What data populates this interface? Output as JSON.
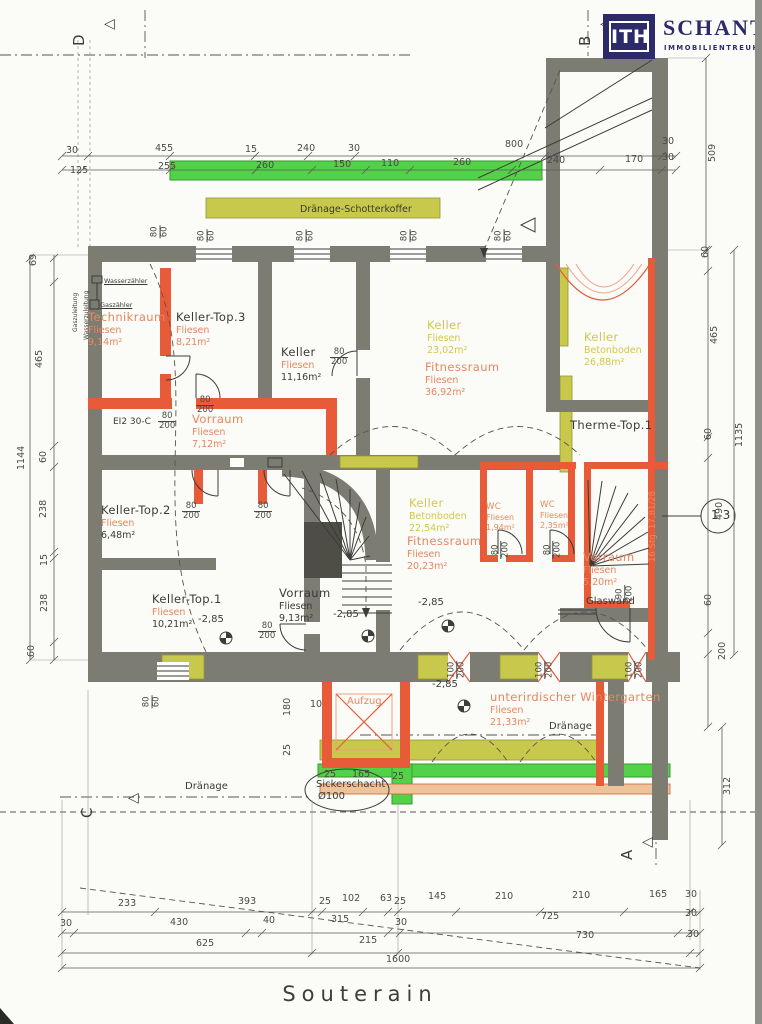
{
  "page": {
    "title": "Souterain"
  },
  "logo": {
    "abbr": "ITH",
    "name": "SCHANTL",
    "subtitle": "IMMOBILIENTREUHAND"
  },
  "colors": {
    "navy": "#2c2a6b",
    "wall": "#7c7c73",
    "orange": "#e75b38",
    "orange_light": "#f0a184",
    "text_orange": "#e8875e",
    "text_yellow": "#d5c749",
    "text_black": "#3a3a36",
    "dim_text": "#4a4a45",
    "green": "#53d148",
    "green_dark": "#2e9e2f",
    "olive": "#c8c84d",
    "olive_dark": "#97972f",
    "tan": "#eec39a"
  },
  "plan": {
    "rooms": [
      {
        "n": "room-technikraum",
        "name": "Technikraum",
        "floor": "Fliesen",
        "area": "9,14m²",
        "x": 88,
        "y": 310,
        "nc": "org",
        "fc": "org",
        "ac": "org"
      },
      {
        "n": "room-keller-top3",
        "name": "Keller-Top.3",
        "floor": "Fliesen",
        "area": "8,21m²",
        "x": 176,
        "y": 310,
        "nc": "blk",
        "fc": "org",
        "ac": "org"
      },
      {
        "n": "room-keller-11",
        "name": "Keller",
        "floor": "Fliesen",
        "area": "11,16m²",
        "x": 281,
        "y": 345,
        "nc": "blk",
        "fc": "org",
        "ac": "blk"
      },
      {
        "n": "room-keller-23",
        "name": "Keller",
        "floor": "Fliesen",
        "area": "23,02m²",
        "x": 427,
        "y": 318,
        "nc": "yel",
        "fc": "yel",
        "ac": "yel"
      },
      {
        "n": "room-fitnessraum-36",
        "name": "Fitnessraum",
        "floor": "Fliesen",
        "area": "36,92m²",
        "x": 425,
        "y": 360,
        "nc": "org",
        "fc": "org",
        "ac": "org"
      },
      {
        "n": "room-keller-26",
        "name": "Keller",
        "floor": "Betonboden",
        "area": "26,88m²",
        "x": 584,
        "y": 330,
        "nc": "yel",
        "fc": "yel",
        "ac": "yel"
      },
      {
        "n": "room-therme-top1",
        "name": "Therme-Top.1",
        "floor": "",
        "area": "",
        "x": 570,
        "y": 418,
        "nc": "blk",
        "fc": "blk",
        "ac": "blk"
      },
      {
        "n": "room-vorraum-7",
        "name": "Vorraum",
        "floor": "Fliesen",
        "area": "7,12m²",
        "x": 192,
        "y": 412,
        "nc": "org",
        "fc": "org",
        "ac": "org"
      },
      {
        "n": "room-keller-top2",
        "name": "Keller-Top.2",
        "floor": "Fliesen",
        "area": "6,48m²",
        "x": 101,
        "y": 503,
        "nc": "blk",
        "fc": "org",
        "ac": "blk"
      },
      {
        "n": "room-vorraum-9",
        "name": "Vorraum",
        "floor": "Fliesen",
        "area": "9,13m²",
        "x": 279,
        "y": 586,
        "nc": "blk",
        "fc": "blk",
        "ac": "blk"
      },
      {
        "n": "room-keller-22",
        "name": "Keller",
        "floor": "Betonboden",
        "area": "22,54m²",
        "x": 409,
        "y": 496,
        "nc": "yel",
        "fc": "yel",
        "ac": "yel"
      },
      {
        "n": "room-fitnessraum-20",
        "name": "Fitnessraum",
        "floor": "Fliesen",
        "area": "20,23m²",
        "x": 407,
        "y": 534,
        "nc": "org",
        "fc": "org",
        "ac": "org"
      },
      {
        "n": "room-wc-1",
        "name": "WC",
        "floor": "Fliesen",
        "area": "1,94m²",
        "x": 486,
        "y": 502,
        "nc": "org",
        "fc": "org",
        "ac": "org",
        "sm": 1
      },
      {
        "n": "room-wc-2",
        "name": "WC",
        "floor": "Fliesen",
        "area": "2,35m²",
        "x": 540,
        "y": 500,
        "nc": "org",
        "fc": "org",
        "ac": "org",
        "sm": 1
      },
      {
        "n": "room-vorraum-5",
        "name": "Vorraum",
        "floor": "Fliesen",
        "area": "5,20m²",
        "x": 583,
        "y": 550,
        "nc": "org",
        "fc": "org",
        "ac": "org"
      },
      {
        "n": "room-keller-top1",
        "name": "Keller-Top.1",
        "floor": "Fliesen",
        "area": "10,21m²",
        "x": 152,
        "y": 592,
        "nc": "blk",
        "fc": "org",
        "ac": "blk"
      },
      {
        "n": "room-wintergarten",
        "name": "unterirdischer Wintergarten",
        "floor": "Fliesen",
        "area": "21,33m²",
        "x": 490,
        "y": 690,
        "nc": "org",
        "fc": "org",
        "ac": "org"
      }
    ],
    "texts": [
      {
        "n": "draenage-schotterkoffer-label",
        "t": "Dränage-Schotterkoffer",
        "x": 300,
        "y": 205,
        "s": 9.5
      },
      {
        "n": "draenage-label-mid",
        "t": "Dränage",
        "x": 549,
        "y": 722,
        "s": 10
      },
      {
        "n": "draenage-label-left",
        "t": "Dränage",
        "x": 185,
        "y": 782,
        "s": 10
      },
      {
        "n": "sickerschacht-label",
        "t": "Sickerschacht",
        "x": 316,
        "y": 780,
        "s": 10
      },
      {
        "n": "sickerschacht-diameter",
        "t": "Ø100",
        "x": 318,
        "y": 792,
        "s": 10
      },
      {
        "n": "glaswand-label",
        "t": "Glaswand",
        "x": 586,
        "y": 597,
        "s": 10
      },
      {
        "n": "aufzug-label",
        "t": "Aufzug",
        "x": 347,
        "y": 697,
        "s": 10,
        "c": "org"
      },
      {
        "n": "fire-door-label",
        "t": "EI2 30-C",
        "x": 113,
        "y": 418,
        "s": 9
      },
      {
        "n": "wasserzaehler-label",
        "t": "Wasserzähler",
        "x": 104,
        "y": 278,
        "s": 6.5,
        "u": 1
      },
      {
        "n": "gaszaehler-label",
        "t": "Gaszähler",
        "x": 100,
        "y": 302,
        "s": 6.5,
        "u": 1
      },
      {
        "n": "gaszuleitung-label",
        "t": "Gaszuleitung",
        "x": 73,
        "y": 332,
        "s": 6,
        "r": -90
      },
      {
        "n": "wasserzuleitung-label",
        "t": "Wasserzuleitung",
        "x": 84,
        "y": 340,
        "s": 6,
        "r": -90
      },
      {
        "n": "stair-count-label",
        "t": "16 Stg. 17,81/28",
        "x": 649,
        "y": 562,
        "s": 8.5,
        "r": -90,
        "c": "org"
      },
      {
        "n": "detail-circle-label",
        "t": "13",
        "x": 711,
        "y": 509,
        "s": 12,
        "ls": 4
      }
    ],
    "levels": [
      {
        "n": "level-label",
        "t": "-2,85",
        "x": 333,
        "y": 610
      },
      {
        "n": "level-label",
        "t": "-2,85",
        "x": 418,
        "y": 598
      },
      {
        "n": "level-label",
        "t": "-2,85",
        "x": 198,
        "y": 615
      },
      {
        "n": "level-label",
        "t": "-2,85",
        "x": 432,
        "y": 680
      }
    ],
    "fracs": [
      {
        "t": "80/200",
        "x": 330,
        "y": 348
      },
      {
        "t": "80/200",
        "x": 196,
        "y": 396
      },
      {
        "t": "80/200",
        "x": 158,
        "y": 412
      },
      {
        "t": "80/200",
        "x": 182,
        "y": 502
      },
      {
        "t": "80/200",
        "x": 254,
        "y": 502
      },
      {
        "t": "80/200",
        "x": 258,
        "y": 622
      },
      {
        "t": "80/200",
        "x": 492,
        "y": 540,
        "r": -90
      },
      {
        "t": "80/200",
        "x": 544,
        "y": 540,
        "r": -90
      },
      {
        "t": "90/200",
        "x": 616,
        "y": 584,
        "r": -90
      },
      {
        "t": "80/60",
        "x": 154,
        "y": 222,
        "r": -90
      },
      {
        "t": "80/60",
        "x": 201,
        "y": 226,
        "r": -90
      },
      {
        "t": "80/60",
        "x": 300,
        "y": 226,
        "r": -90
      },
      {
        "t": "80/60",
        "x": 404,
        "y": 226,
        "r": -90
      },
      {
        "t": "80/60",
        "x": 498,
        "y": 226,
        "r": -90
      },
      {
        "t": "80/60",
        "x": 146,
        "y": 692,
        "r": -90
      },
      {
        "t": "100/200",
        "x": 448,
        "y": 660,
        "r": -90
      },
      {
        "t": "100/200",
        "x": 536,
        "y": 660,
        "r": -90
      },
      {
        "t": "100/200",
        "x": 626,
        "y": 660,
        "r": -90
      }
    ],
    "dims": [
      {
        "t": "30",
        "x": 66,
        "y": 146
      },
      {
        "t": "455",
        "x": 155,
        "y": 144
      },
      {
        "t": "15",
        "x": 245,
        "y": 145
      },
      {
        "t": "240",
        "x": 297,
        "y": 144
      },
      {
        "t": "30",
        "x": 348,
        "y": 144
      },
      {
        "t": "800",
        "x": 505,
        "y": 140
      },
      {
        "t": "30",
        "x": 662,
        "y": 137
      },
      {
        "t": "125",
        "x": 70,
        "y": 166
      },
      {
        "t": "255",
        "x": 158,
        "y": 162
      },
      {
        "t": "260",
        "x": 256,
        "y": 161
      },
      {
        "t": "150",
        "x": 333,
        "y": 160
      },
      {
        "t": "110",
        "x": 381,
        "y": 159
      },
      {
        "t": "260",
        "x": 453,
        "y": 158
      },
      {
        "t": "240",
        "x": 547,
        "y": 156
      },
      {
        "t": "170",
        "x": 625,
        "y": 155
      },
      {
        "t": "30",
        "x": 662,
        "y": 153
      },
      {
        "t": "509",
        "x": 708,
        "y": 162,
        "r": -90
      },
      {
        "t": "60",
        "x": 701,
        "y": 258,
        "r": -90
      },
      {
        "t": "465",
        "x": 710,
        "y": 344,
        "r": -90
      },
      {
        "t": "60",
        "x": 704,
        "y": 440,
        "r": -90
      },
      {
        "t": "1135",
        "x": 735,
        "y": 447,
        "r": -90
      },
      {
        "t": "490",
        "x": 715,
        "y": 520,
        "r": -90
      },
      {
        "t": "60",
        "x": 704,
        "y": 606,
        "r": -90
      },
      {
        "t": "200",
        "x": 718,
        "y": 660,
        "r": -90
      },
      {
        "t": "312",
        "x": 723,
        "y": 795,
        "r": -90
      },
      {
        "t": "69",
        "x": 29,
        "y": 266,
        "r": -90
      },
      {
        "t": "465",
        "x": 35,
        "y": 368,
        "r": -90
      },
      {
        "t": "60",
        "x": 39,
        "y": 463,
        "r": -90
      },
      {
        "t": "1144",
        "x": 17,
        "y": 470,
        "r": -90
      },
      {
        "t": "238",
        "x": 39,
        "y": 518,
        "r": -90
      },
      {
        "t": "15",
        "x": 40,
        "y": 566,
        "r": -90
      },
      {
        "t": "238",
        "x": 40,
        "y": 612,
        "r": -90
      },
      {
        "t": "60",
        "x": 27,
        "y": 657,
        "r": -90
      },
      {
        "t": "233",
        "x": 118,
        "y": 899
      },
      {
        "t": "393",
        "x": 238,
        "y": 897
      },
      {
        "t": "25",
        "x": 319,
        "y": 897
      },
      {
        "t": "102",
        "x": 342,
        "y": 894
      },
      {
        "t": "63",
        "x": 380,
        "y": 894
      },
      {
        "t": "25",
        "x": 394,
        "y": 897
      },
      {
        "t": "145",
        "x": 428,
        "y": 892
      },
      {
        "t": "210",
        "x": 495,
        "y": 892
      },
      {
        "t": "210",
        "x": 572,
        "y": 891
      },
      {
        "t": "165",
        "x": 649,
        "y": 890
      },
      {
        "t": "30",
        "x": 685,
        "y": 890
      },
      {
        "t": "30",
        "x": 60,
        "y": 919
      },
      {
        "t": "430",
        "x": 170,
        "y": 918
      },
      {
        "t": "40",
        "x": 263,
        "y": 916
      },
      {
        "t": "315",
        "x": 331,
        "y": 915
      },
      {
        "t": "30",
        "x": 395,
        "y": 918
      },
      {
        "t": "725",
        "x": 541,
        "y": 912
      },
      {
        "t": "30",
        "x": 685,
        "y": 909
      },
      {
        "t": "625",
        "x": 196,
        "y": 939
      },
      {
        "t": "215",
        "x": 359,
        "y": 936
      },
      {
        "t": "730",
        "x": 576,
        "y": 931
      },
      {
        "t": "30",
        "x": 687,
        "y": 930
      },
      {
        "t": "1600",
        "x": 386,
        "y": 955
      },
      {
        "t": "180",
        "x": 283,
        "y": 716,
        "r": -90
      },
      {
        "t": "25",
        "x": 283,
        "y": 756,
        "r": -90
      },
      {
        "t": "10",
        "x": 310,
        "y": 700
      },
      {
        "t": "25",
        "x": 324,
        "y": 770
      },
      {
        "t": "165",
        "x": 352,
        "y": 770
      },
      {
        "t": "25",
        "x": 392,
        "y": 772
      }
    ],
    "markers": [
      {
        "letter": "D",
        "x": 70,
        "y": 46,
        "tx": 104,
        "ty": 16
      },
      {
        "letter": "B",
        "x": 576,
        "y": 46,
        "tx": 600,
        "ty": 16
      },
      {
        "letter": "C",
        "x": 78,
        "y": 818,
        "tx": 128,
        "ty": 790
      },
      {
        "letter": "A",
        "x": 618,
        "y": 860,
        "tx": 642,
        "ty": 834
      }
    ]
  }
}
